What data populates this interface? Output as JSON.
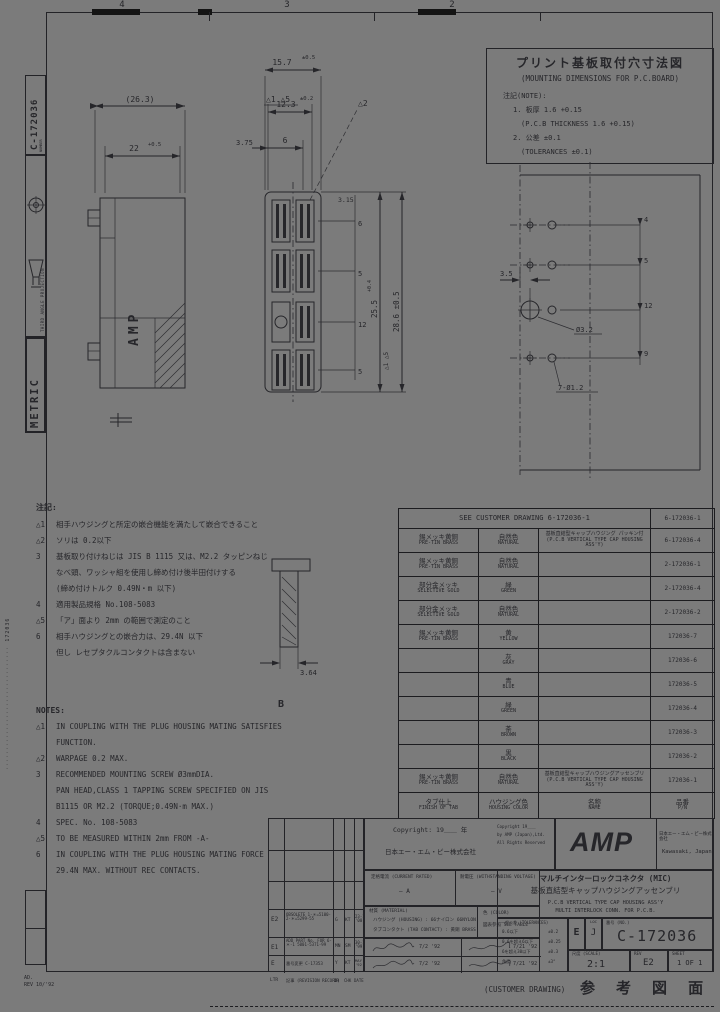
{
  "colors": {
    "paper": "#7b7b7b",
    "ink": "#26262a",
    "line": "#1c1c1f"
  },
  "grid": {
    "c4": "4",
    "c3": "3",
    "c2": "2"
  },
  "sidebar": {
    "number_label": "NUMBER",
    "number": "C-172036",
    "projection": "THIRD ANGLE PROJECTION",
    "metric": "METRIC",
    "edge_code": "······························· 172036",
    "plot_note1": "AD.",
    "plot_note2": "REV 10/'92"
  },
  "pcb_note": {
    "title_jp": "プリント基板取付穴寸法図",
    "title_en": "(MOUNTING DIMENSIONS FOR P.C.BOARD)",
    "note_label": "注記(NOTE):",
    "line1": "1. 板厚 1.6 +0.15",
    "line2": "(P.C.B THICKNESS 1.6 +0.15)",
    "line3": "2. 公差 ±0.1",
    "line4": "(TOLERANCES ±0.1)"
  },
  "dims": {
    "d26": "(26.3)",
    "d22": "22",
    "d22t": "+0.5",
    "d157": "15.7",
    "d157t": "±0.5",
    "d123": "12.3",
    "d123t": "±0.2",
    "d375": "3.75",
    "d6": "6",
    "flag15": "△1 △5",
    "flag2": "△2",
    "d255": "25.5",
    "d255t": "+0.4",
    "d255f": "△1 △5",
    "d286": "28.6 ±0.5",
    "d315": "3.15",
    "c1": "6",
    "c2": "5",
    "c3": "12",
    "c4": "5",
    "p35": "3.5",
    "p32": "Ø3.2",
    "p12": "7-Ø1.2",
    "pc1": "4",
    "pc2": "5",
    "pc3": "12",
    "pc4": "9",
    "d364": "3.64",
    "label_b": "B",
    "amp_mold": "AMP"
  },
  "notes_jp": {
    "heading": "注記:",
    "lines": [
      {
        "m": "△1",
        "t": "相手ハウジングと所定の嵌合機能を満たして嵌合できること"
      },
      {
        "m": "△2",
        "t": "ソリは 0.2以下"
      },
      {
        "m": "3",
        "t": "基板取り付けねじは JIS B 1115 又は、M2.2 タッピンねじ"
      },
      {
        "m": "",
        "t": "なべ頭、ワッシャ組を使用し締め付け後半田付けする"
      },
      {
        "m": "",
        "t": "(締め付けトルク 0.49N・m 以下)"
      },
      {
        "m": "4",
        "t": "適用製品規格 No.108-5083"
      },
      {
        "m": "△5",
        "t": "「ア」面より 2mm の範囲で測定のこと"
      },
      {
        "m": "6",
        "t": "相手ハウジングとの嵌合力は、29.4N 以下"
      },
      {
        "m": "",
        "t": "但し レセプタクルコンタクトは含まない"
      }
    ]
  },
  "notes_en": {
    "heading": "NOTES:",
    "lines": [
      {
        "m": "△1",
        "t": "IN COUPLING WITH THE PLUG HOUSING MATING SATISFIES"
      },
      {
        "m": "",
        "t": "FUNCTION."
      },
      {
        "m": "△2",
        "t": "WARPAGE 0.2 MAX."
      },
      {
        "m": "3",
        "t": "RECOMMENDED MOUNTING SCREW Ø3mmDIA."
      },
      {
        "m": "",
        "t": "PAN HEAD,CLASS 1 TAPPING SCREW SPECIFIED ON JIS"
      },
      {
        "m": "",
        "t": "B1115 OR M2.2 (TORQUE;0.49N·m MAX.)"
      },
      {
        "m": "4",
        "t": "SPEC. No. 108-5083"
      },
      {
        "m": "△5",
        "t": "TO BE MEASURED WITHIN 2mm FROM -A-"
      },
      {
        "m": "6",
        "t": "IN COUPLING WITH THE PLUG HOUSING MATING FORCE"
      },
      {
        "m": "",
        "t": "29.4N MAX. WITHOUT REC CONTACTS."
      }
    ]
  },
  "table": {
    "header_left": "SEE CUSTOMER DRAWING 6-172036-1",
    "header_right": "6-172036-1",
    "rows": [
      {
        "finish": "錫メッキ黄銅",
        "finish_en": "PRE-TIN BRASS",
        "color": "自然色",
        "color_en": "NATURAL",
        "name": "基板直結型キャップハウジング パッキン付",
        "name_en": "(P.C.B VERTICAL TYPE CAP HOUSING ASS'Y)",
        "pn": "6-172036-4"
      },
      {
        "finish": "錫メッキ黄銅",
        "finish_en": "PRE-TIN BRASS",
        "color": "自然色",
        "color_en": "NATURAL",
        "name": "",
        "name_en": "",
        "pn": "2-172036-1"
      },
      {
        "finish": "部分金メッキ",
        "finish_en": "SELECTIVE GOLD",
        "color": "緑",
        "color_en": "GREEN",
        "name": "",
        "name_en": "",
        "pn": "2-172036-4"
      },
      {
        "finish": "部分金メッキ",
        "finish_en": "SELECTIVE GOLD",
        "color": "自然色",
        "color_en": "NATURAL",
        "name": "",
        "name_en": "",
        "pn": "2-172036-2"
      },
      {
        "finish": "錫メッキ黄銅",
        "finish_en": "PRE-TIN BRASS",
        "color": "黄",
        "color_en": "YELLOW",
        "name": "",
        "name_en": "",
        "pn": "172036-7"
      },
      {
        "finish": "",
        "finish_en": "",
        "color": "灰",
        "color_en": "GRAY",
        "name": "",
        "name_en": "",
        "pn": "172036-6"
      },
      {
        "finish": "",
        "finish_en": "",
        "color": "青",
        "color_en": "BLUE",
        "name": "",
        "name_en": "",
        "pn": "172036-5"
      },
      {
        "finish": "",
        "finish_en": "",
        "color": "緑",
        "color_en": "GREEN",
        "name": "",
        "name_en": "",
        "pn": "172036-4"
      },
      {
        "finish": "",
        "finish_en": "",
        "color": "茶",
        "color_en": "BROWN",
        "name": "",
        "name_en": "",
        "pn": "172036-3"
      },
      {
        "finish": "",
        "finish_en": "",
        "color": "黒",
        "color_en": "BLACK",
        "name": "",
        "name_en": "",
        "pn": "172036-2"
      },
      {
        "finish": "錫メッキ黄銅",
        "finish_en": "PRE-TIN BRASS",
        "color": "自然色",
        "color_en": "NATURAL",
        "name": "基板直結型キャップハウジングアッセンブリ",
        "name_en": "(P.C.B VERTICAL TYPE CAP HOUSING ASS'Y)",
        "pn": "172036-1"
      }
    ],
    "footer": {
      "finish": "タブ仕上",
      "finish_en": "FINISH OF TAB",
      "color": "ハウジング色",
      "color_en": "HOUSING COLOR",
      "name": "名称",
      "name_en": "NAME",
      "pn": "品番",
      "pn_en": "P/N"
    }
  },
  "titleblock": {
    "rev_rows": [
      {
        "ltr": "E2",
        "desc": "OBSOLETE 1-＊=5100- 2-＊=5299-55",
        "dr": "G",
        "chk": "KT",
        "date": "23-1 '00"
      },
      {
        "ltr": "E1",
        "desc": "ADD PART No. FOR 6-＊-1 5001-5371-99",
        "dr": "MN",
        "chk": "SM",
        "date": "30-1 '99"
      },
      {
        "ltr": "E",
        "desc": "番号変更 C-17353",
        "dr": "Y",
        "chk": "KT",
        "date": "MAY '92"
      },
      {
        "ltr": "LTR",
        "desc": "記事 (REVISION RECORD)",
        "dr": "DR",
        "chk": "CHK",
        "date": "DATE"
      }
    ],
    "copyright1": "Copyright: 19＿＿ 年",
    "copyright2": "日本エー・エム・ピー株式会社",
    "copyright_sub": [
      "Copyright 19＿＿",
      "by AMP (Japan),Ltd.",
      "All Rights Reserved"
    ],
    "rating_l_label": "定格電流 (CURRENT RATED)",
    "rating_l_value": "― A",
    "rating_r_label": "耐電圧 (WITHSTANDING VOLTAGE)",
    "rating_r_value": "― V",
    "material_label": "材質 (MATERIAL)",
    "material1": "ハウジング (HOUSING) : 66ナイロン 66NYLON",
    "material2": "タブコンタクト (TAB CONTACT) : 黄銅 BRASS",
    "color_label": "色 (COLOR)",
    "color_value": "図表参照 SEE TABLE",
    "sig_date1": "7/2 '92",
    "sig_date2": "7/21 '92",
    "sig_date3": "7/2 '92",
    "sig_date4": "7/21 '92",
    "brand": "AMP",
    "company_jp": "日本エー・エム・ピー株式会社",
    "company_en": "Kawasaki, Japan",
    "title_jp1": "マルチインターロックコネクタ (MIC)",
    "title_jp2": "基板直結型キャップハウジングアッセンブリ",
    "title_en1": "P.C.B VERTICAL TYPE CAP HOUSING ASS'Y",
    "title_en2": "MULTI INTERLOCK CONN. FOR P.C.B.",
    "tol_label": "一般公差 (TOLERANCES)",
    "tol_rows": [
      {
        "r": "0.6以下",
        "v": "±0.2"
      },
      {
        "r": "0.6を超え6以下",
        "v": "±0.25"
      },
      {
        "r": "6を超え30以下",
        "v": "±0.3"
      },
      {
        "r": "角度",
        "v": "±3°"
      }
    ],
    "size": "E",
    "loc_label": "LOC",
    "loc": "J",
    "no_label": "番号 (NO.)",
    "number": "C-172036",
    "scale_label": "尺度 (SCALE)",
    "scale": "2:1",
    "rev_label": "REV",
    "rev": "E2",
    "sheet_label": "SHEET",
    "sheet": "1 OF 1"
  },
  "footer": {
    "customer": "(CUSTOMER DRAWING)",
    "reference": "参 考 図 面"
  }
}
